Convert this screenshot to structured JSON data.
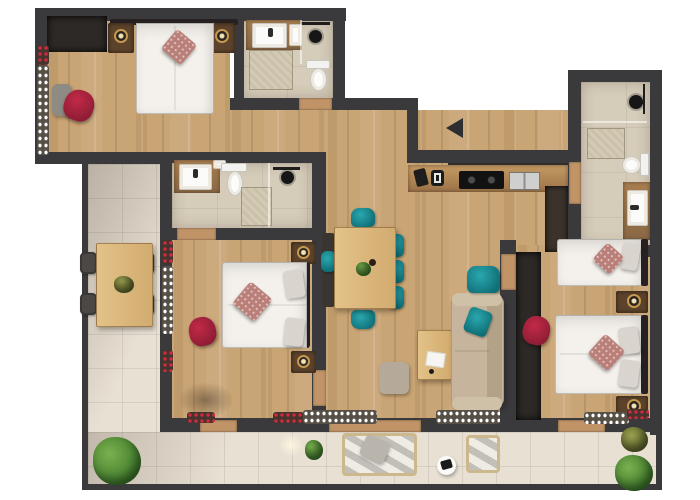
{
  "meta": {
    "type": "apartment floor plan",
    "view": "top-down 3D render",
    "description": "Rendered floor plan of a multi-room apartment with L-shaped tiled terrace, three bedrooms, three bathrooms, kitchen-living area and an entrance marked with a black arrow"
  },
  "palette": {
    "outside": "#ffffff",
    "wall": "#3a393b",
    "wood": "#c9a474",
    "wood_dark": "#8a6844",
    "tile": "#e8e0d3",
    "bath_tile": "#d6ccba",
    "accent_teal": "#17868e",
    "accent_red": "#a8233d",
    "bedding": "#f4f1ec",
    "sofa": "#c6b59c",
    "plant_green": "#55923a",
    "counter": "#d9b877"
  },
  "entrance": {
    "marker": "black triangle arrow pointing left",
    "arrow_color": "#2e2e30"
  },
  "rooms": [
    {
      "id": "bedroom-1",
      "label": "Bedroom top-left",
      "furniture": [
        "double bed with white duvet and patterned pillow",
        "two nightstands with brass lamps",
        "built-in wardrobe",
        "red armchair",
        "grey side table",
        "window flower boxes"
      ]
    },
    {
      "id": "bathroom-1",
      "label": "Bathroom top-middle",
      "furniture": [
        "washbasin on wood counter",
        "white cabinet",
        "shower with black head",
        "toilet",
        "bath mat"
      ]
    },
    {
      "id": "bathroom-2",
      "label": "Bathroom middle-left",
      "furniture": [
        "washbasin on wood counter",
        "toilet",
        "shower with black head",
        "bath mat"
      ]
    },
    {
      "id": "bathroom-3",
      "label": "Bathroom top-right",
      "furniture": [
        "shower with black head",
        "bath mat",
        "toilet",
        "wood vanity with washbasin"
      ]
    },
    {
      "id": "kitchen-living",
      "label": "Kitchen and living room",
      "furniture": [
        "kitchenette counter with cooktop and double sink",
        "small appliances",
        "tall dark cabinet",
        "dining table with bench and six teal chairs",
        "plant centerpiece",
        "beige sofa with teal cushion",
        "teal armchair",
        "light wood coffee table with papers",
        "grey pouf"
      ]
    },
    {
      "id": "bedroom-2",
      "label": "Bedroom middle",
      "furniture": [
        "double bed with patterned pillow",
        "two nightstands with brass lamps",
        "red armchair",
        "red window flower boxes"
      ]
    },
    {
      "id": "bedroom-3",
      "label": "Bedroom right",
      "furniture": [
        "single bed",
        "double bed",
        "patterned and grey pillows",
        "two nightstands with brass lamps",
        "dark wardrobe",
        "red armchair"
      ]
    },
    {
      "id": "terrace",
      "label": "L-shaped terrace",
      "furniture": [
        "wood dining table with four dark chairs",
        "plant centerpiece",
        "outdoor sofa",
        "outdoor chair",
        "round white side table with tray",
        "green bushes and potted plants",
        "white and red railing flower boxes"
      ]
    }
  ]
}
